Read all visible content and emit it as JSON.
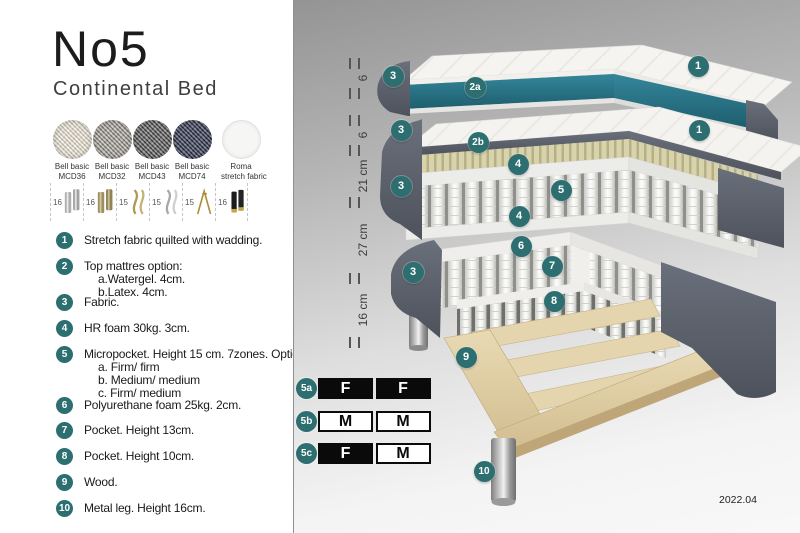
{
  "title": "No5",
  "subtitle": "Continental Bed",
  "fabrics": [
    {
      "line1": "Bell basic",
      "line2": "MCD36",
      "style": "sw-mcd36"
    },
    {
      "line1": "Bell basic",
      "line2": "MCD32",
      "style": "sw-mcd32"
    },
    {
      "line1": "Bell basic",
      "line2": "MCD43",
      "style": "sw-mcd43"
    },
    {
      "line1": "Bell basic",
      "line2": "MCD74",
      "style": "sw-mcd74"
    },
    {
      "line1": "Roma",
      "line2": "stretch fabric",
      "style": "sw-roma"
    }
  ],
  "leg_options": [
    {
      "height": "16",
      "type": "cyl-silver"
    },
    {
      "height": "16",
      "type": "cyl-brass"
    },
    {
      "height": "15",
      "type": "curved-gold"
    },
    {
      "height": "15",
      "type": "curved-silver"
    },
    {
      "height": "15",
      "type": "hairpin-gold"
    },
    {
      "height": "16",
      "type": "cyl-black-gold"
    }
  ],
  "spec_items": [
    {
      "num": "1",
      "top": 232,
      "lines": [
        "Stretch fabric quilted with wadding."
      ]
    },
    {
      "num": "2",
      "top": 258,
      "lines": [
        "Top mattres option:",
        "a.Watergel. 4cm.",
        "b.Latex. 4cm."
      ]
    },
    {
      "num": "3",
      "top": 294,
      "lines": [
        "Fabric."
      ]
    },
    {
      "num": "4",
      "top": 320,
      "lines": [
        "HR foam 30kg. 3cm."
      ]
    },
    {
      "num": "5",
      "top": 346,
      "lines": [
        "Micropocket. Height 15 cm. 7zones. Option:",
        "a. Firm/ firm",
        "b. Medium/ medium",
        "c. Firm/ medium"
      ]
    },
    {
      "num": "6",
      "top": 397,
      "lines": [
        "Polyurethane foam 25kg. 2cm."
      ]
    },
    {
      "num": "7",
      "top": 422,
      "lines": [
        "Pocket. Height 13cm."
      ]
    },
    {
      "num": "8",
      "top": 448,
      "lines": [
        "Pocket. Height 10cm."
      ]
    },
    {
      "num": "9",
      "top": 474,
      "lines": [
        "Wood."
      ]
    },
    {
      "num": "10",
      "top": 500,
      "lines": [
        "Metal leg. Height 16cm."
      ]
    }
  ],
  "diagram": {
    "ruler_labels": [
      {
        "text": "6",
        "y": 78
      },
      {
        "text": "6",
        "y": 135
      },
      {
        "text": "21 cm",
        "y": 176
      },
      {
        "text": "27 cm",
        "y": 240
      },
      {
        "text": "16 cm",
        "y": 310
      }
    ],
    "badges": [
      {
        "label": "3",
        "x": 99,
        "y": 76
      },
      {
        "label": "2a",
        "x": 181,
        "y": 87
      },
      {
        "label": "1",
        "x": 404,
        "y": 66
      },
      {
        "label": "3",
        "x": 107,
        "y": 130
      },
      {
        "label": "2b",
        "x": 184,
        "y": 142
      },
      {
        "label": "1",
        "x": 405,
        "y": 130
      },
      {
        "label": "4",
        "x": 224,
        "y": 164
      },
      {
        "label": "5",
        "x": 267,
        "y": 190
      },
      {
        "label": "4",
        "x": 225,
        "y": 216
      },
      {
        "label": "3",
        "x": 107,
        "y": 186
      },
      {
        "label": "6",
        "x": 227,
        "y": 246
      },
      {
        "label": "7",
        "x": 258,
        "y": 266
      },
      {
        "label": "3",
        "x": 119,
        "y": 272
      },
      {
        "label": "8",
        "x": 260,
        "y": 301
      },
      {
        "label": "9",
        "x": 172,
        "y": 357
      },
      {
        "label": "10",
        "x": 190,
        "y": 471
      }
    ],
    "firmness_rows": [
      {
        "label": "5a",
        "cells": [
          {
            "text": "F",
            "variant": "dark"
          },
          {
            "text": "F",
            "variant": "dark"
          }
        ]
      },
      {
        "label": "5b",
        "cells": [
          {
            "text": "M",
            "variant": "light"
          },
          {
            "text": "M",
            "variant": "light"
          }
        ]
      },
      {
        "label": "5c",
        "cells": [
          {
            "text": "F",
            "variant": "dark"
          },
          {
            "text": "M",
            "variant": "light"
          }
        ]
      }
    ],
    "version": "2022.04"
  },
  "colors": {
    "badge_teal": "#2d6f71",
    "topper_teal": "#2a7e93",
    "fabric_dark_gray": "#5a616c",
    "latex_yellow": "#d6d0a8",
    "wood": "#dfcb9e"
  }
}
